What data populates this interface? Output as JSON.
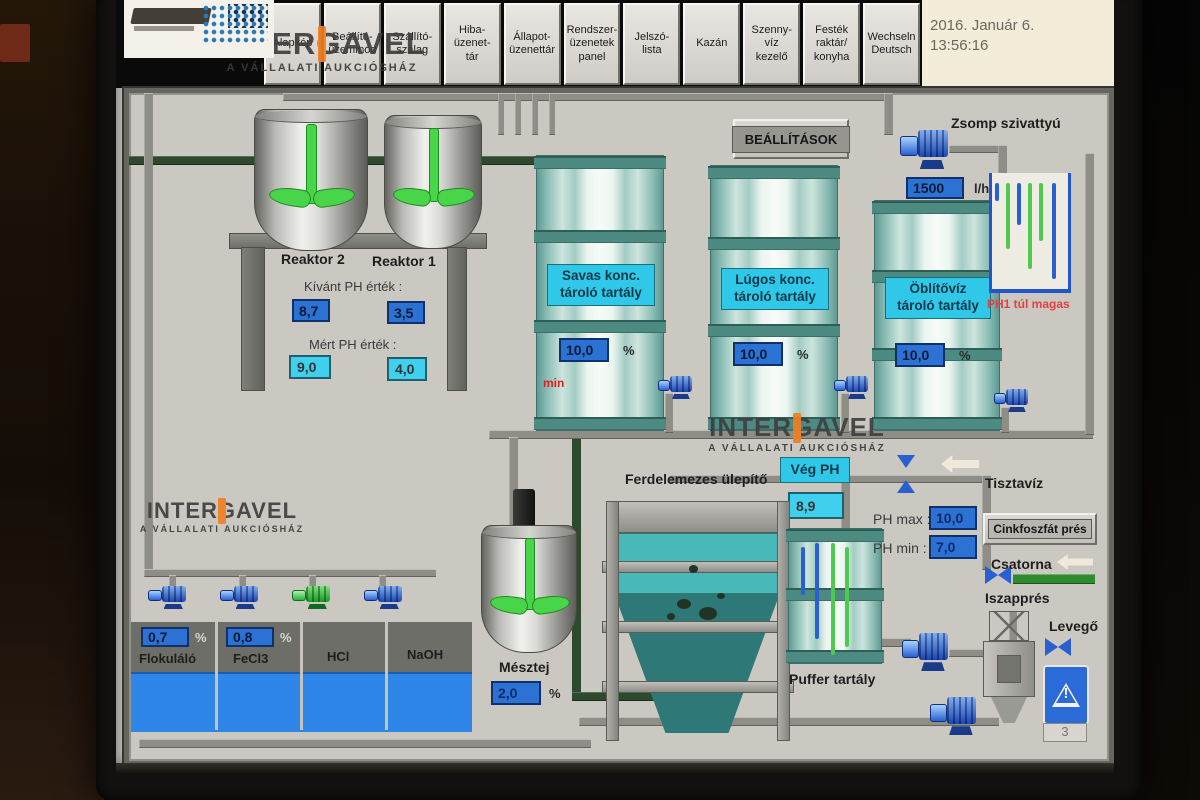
{
  "titlebar": {
    "date": "2016. Január 6.",
    "time": "13:56:16"
  },
  "tabs": [
    {
      "label": "Alapkép"
    },
    {
      "label": "Beállító-\nüzemmód"
    },
    {
      "label": "Szállító-\nszalag"
    },
    {
      "label": "Hiba-\nüzenet-\ntár"
    },
    {
      "label": "Állapot-\nüzenettár"
    },
    {
      "label": "Rendszer-\nüzenetek\npanel"
    },
    {
      "label": "Jelszó-\nlista"
    },
    {
      "label": "Kazán"
    },
    {
      "label": "Szenny-\nvíz\nkezelő"
    },
    {
      "label": "Festék\nraktár/\nkonyha"
    },
    {
      "label": "Wechseln\nDeutsch"
    }
  ],
  "watermark": {
    "brand": "INTERGAVEL",
    "tagline": "A VÁLLALATI AUKCIÓSHÁZ"
  },
  "buttons": {
    "settings": "BEÁLLÍTÁSOK",
    "cink_press": "Cinkfoszfát prés"
  },
  "reactors": {
    "r2_name": "Reaktor 2",
    "r1_name": "Reaktor 1",
    "desired_label": "Kívánt PH érték :",
    "measured_label": "Mért PH érték :",
    "r2_desired": "8,7",
    "r1_desired": "3,5",
    "r2_measured": "9,0",
    "r1_measured": "4,0"
  },
  "storage_tanks": [
    {
      "label": "Savas konc.\ntároló tartály",
      "value": "10,0",
      "unit": "%",
      "min_flag": "min"
    },
    {
      "label": "Lúgos konc.\ntároló tartály",
      "value": "10,0",
      "unit": "%"
    },
    {
      "label": "Öblítővíz\ntároló tartály",
      "value": "10,0",
      "unit": "%"
    }
  ],
  "zsomp": {
    "label": "Zsomp szivattyú",
    "flow": "1500",
    "unit": "l/h",
    "alarm": "PH1 túl magas"
  },
  "clarifier_label": "Ferdelemezes ülepítő",
  "veg_ph": {
    "label": "Vég PH",
    "value": "8,9"
  },
  "puffer_label": "Puffer tartály",
  "ph_limits": {
    "max_label": "PH max :",
    "max": "10,0",
    "min_label": "PH min :",
    "min": "7,0"
  },
  "labels": {
    "tisztaviz": "Tisztavíz",
    "csatorna": "Csatorna",
    "iszappres": "Iszapprés",
    "levego": "Levegő",
    "warn_count": "3"
  },
  "mesztej": {
    "label": "Mésztej",
    "value": "2,0",
    "unit": "%"
  },
  "chemicals": [
    {
      "name": "Flokuláló",
      "value": "0,7",
      "unit": "%"
    },
    {
      "name": "FeCl3",
      "value": "0,8",
      "unit": "%"
    },
    {
      "name": "HCl"
    },
    {
      "name": "NaOH"
    }
  ],
  "colors": {
    "accent_cyan": "#2fc8e8",
    "value_blue": "#2b72d4",
    "liquid_blue": "#2e86e8",
    "alarm_red": "#e03030",
    "pump_green": "#22bb33",
    "watermark_orange": "#f08020"
  }
}
